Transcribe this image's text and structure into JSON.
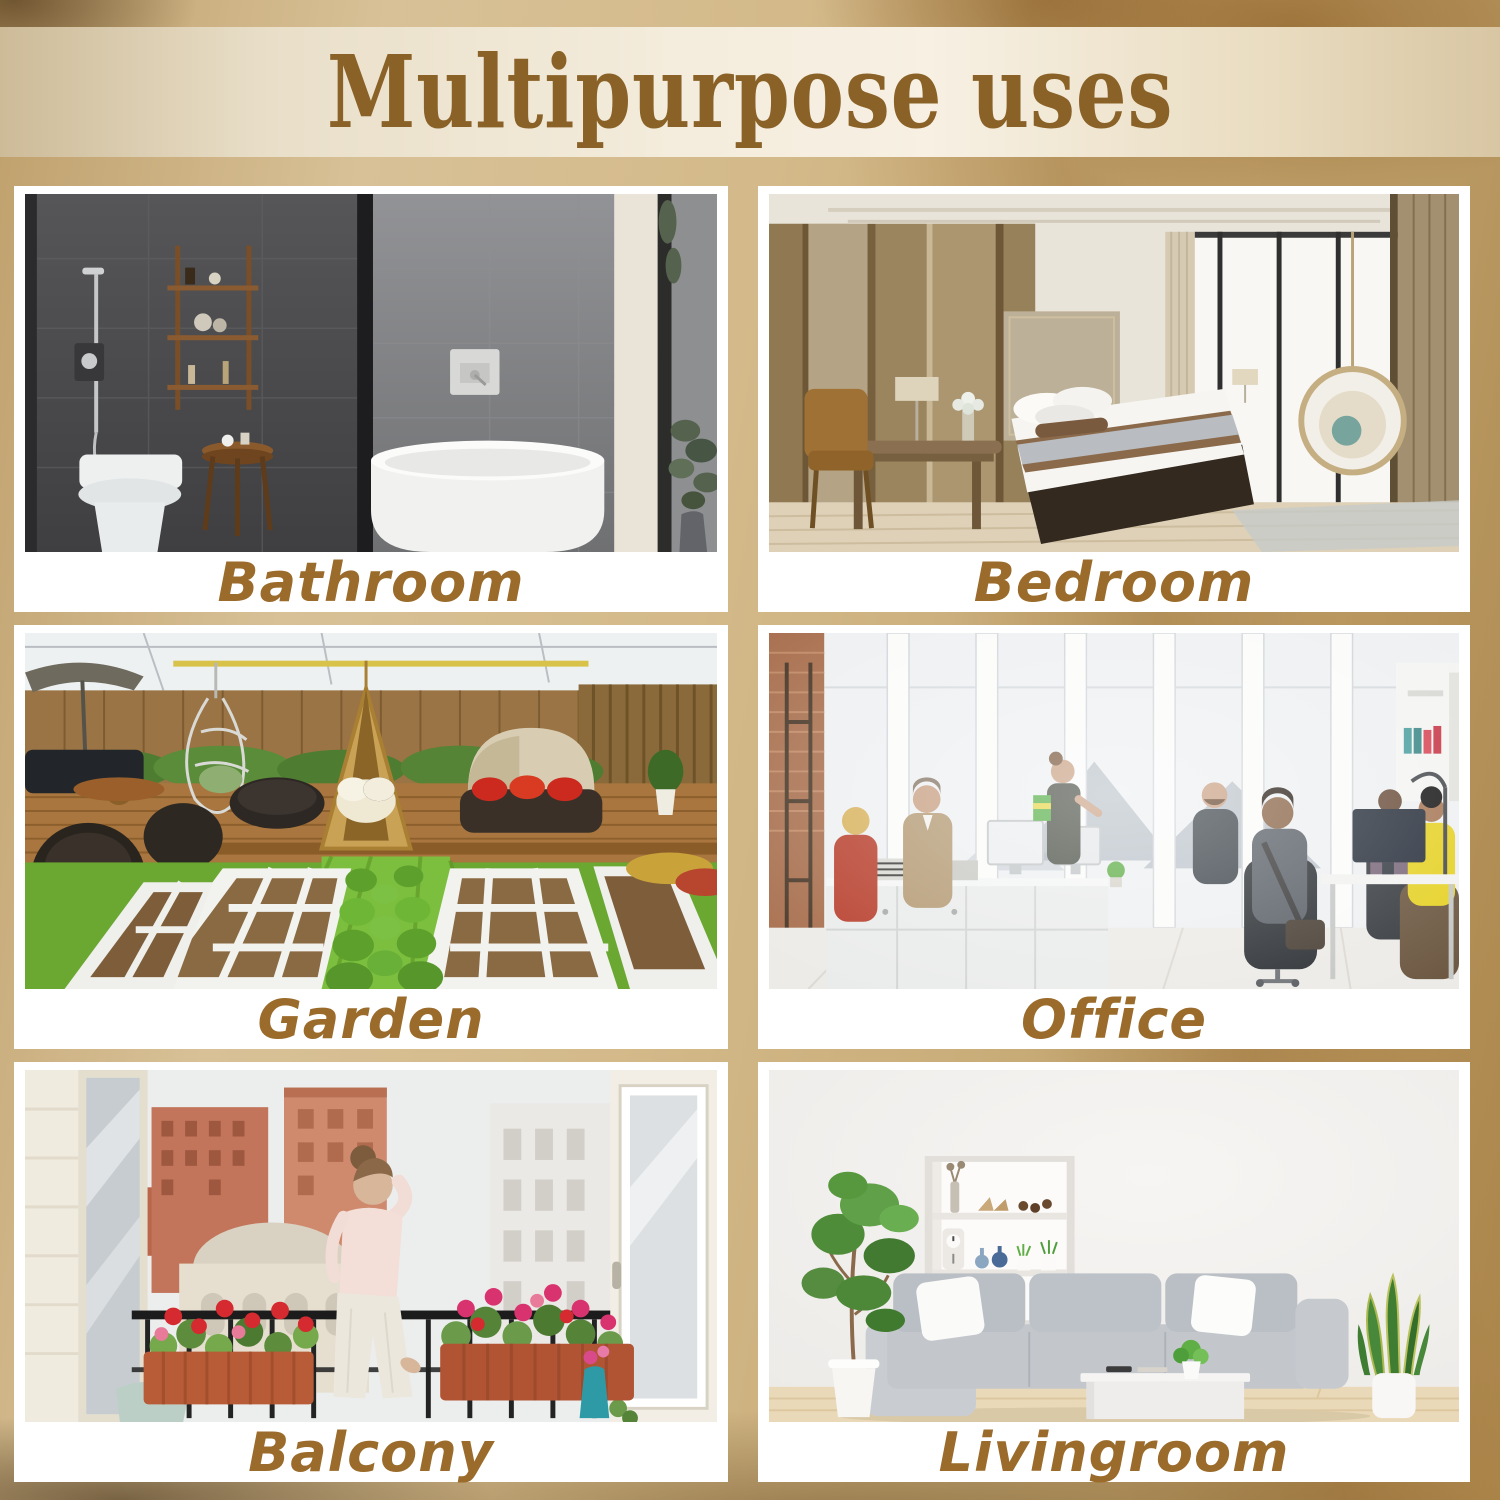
{
  "header": {
    "title": "Multipurpose uses"
  },
  "cards": [
    {
      "name": "bathroom",
      "label": "Bathroom"
    },
    {
      "name": "bedroom",
      "label": "Bedroom"
    },
    {
      "name": "garden",
      "label": "Garden"
    },
    {
      "name": "office",
      "label": "Office"
    },
    {
      "name": "balcony",
      "label": "Balcony"
    },
    {
      "name": "livingroom",
      "label": "Livingroom"
    }
  ],
  "colors": {
    "background_gold": "#d2b788",
    "background_dark_bronze": "#8a5f28",
    "banner_cream": "#f3ead9",
    "title_brown": "#8a6227",
    "label_brown": "#9a6b2a",
    "card_white": "#ffffff"
  }
}
